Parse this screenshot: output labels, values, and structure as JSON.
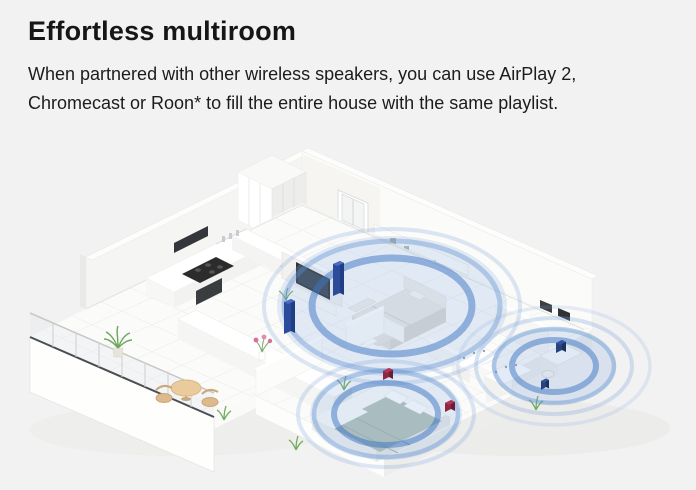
{
  "page": {
    "background_color": "#f2f2f2",
    "heading": "Effortless multiroom",
    "body_line_1": "When partnered with other wireless speakers, you can use AirPlay 2,",
    "body_line_2": "Chromecast or Roon* to fill the entire house with the same playlist.",
    "text_color": "#1a1a1a"
  },
  "illustration": {
    "type": "isometric-apartment-cutaway",
    "rooms": [
      "kitchen",
      "living room",
      "balcony",
      "bedroom",
      "bathroom",
      "office"
    ],
    "speakers": [
      {
        "name": "floorstanding-speaker-left",
        "room": "living room",
        "color": "#2a4c9b"
      },
      {
        "name": "floorstanding-speaker-right",
        "room": "living room",
        "color": "#2a4c9b"
      },
      {
        "name": "compact-speaker-left",
        "room": "bedroom",
        "color": "#8e2745"
      },
      {
        "name": "compact-speaker-right",
        "room": "bedroom",
        "color": "#8e2745"
      },
      {
        "name": "desk-speaker",
        "room": "office",
        "color": "#27437e"
      },
      {
        "name": "floor-speaker",
        "room": "office",
        "color": "#27437e"
      }
    ],
    "colors": {
      "wave_strong": "#3b74c4",
      "wave_mid": "#5b8fd0",
      "wave_soft": "#7da5dc",
      "tower_speaker": "#2a4c9b",
      "tower_speaker_light": "#4a6cc2",
      "compact_speaker_red": "#8e2745",
      "compact_speaker_red_light": "#b23457",
      "desk_speaker_navy": "#27437e"
    }
  }
}
